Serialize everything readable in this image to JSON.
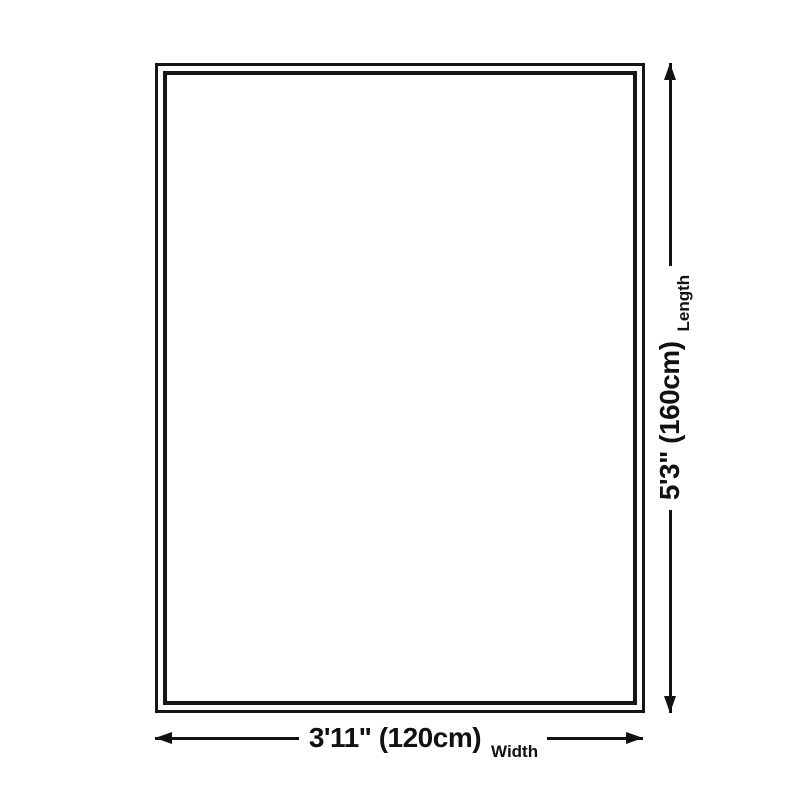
{
  "dimensions": {
    "width": {
      "value": "3'11\" (120cm)",
      "label": "Width"
    },
    "length": {
      "value": "5'3\" (160cm)",
      "label": "Length"
    }
  },
  "icons": {
    "horizontal_arrowheads": [
      "arrowhead-left-icon",
      "arrowhead-right-icon"
    ],
    "vertical_arrowheads": [
      "arrowhead-down-icon",
      "arrowhead-up-icon"
    ]
  },
  "colors": {
    "background": "#ffffff",
    "fill": "#ffffff",
    "border": "#161616",
    "line": "#111111"
  }
}
